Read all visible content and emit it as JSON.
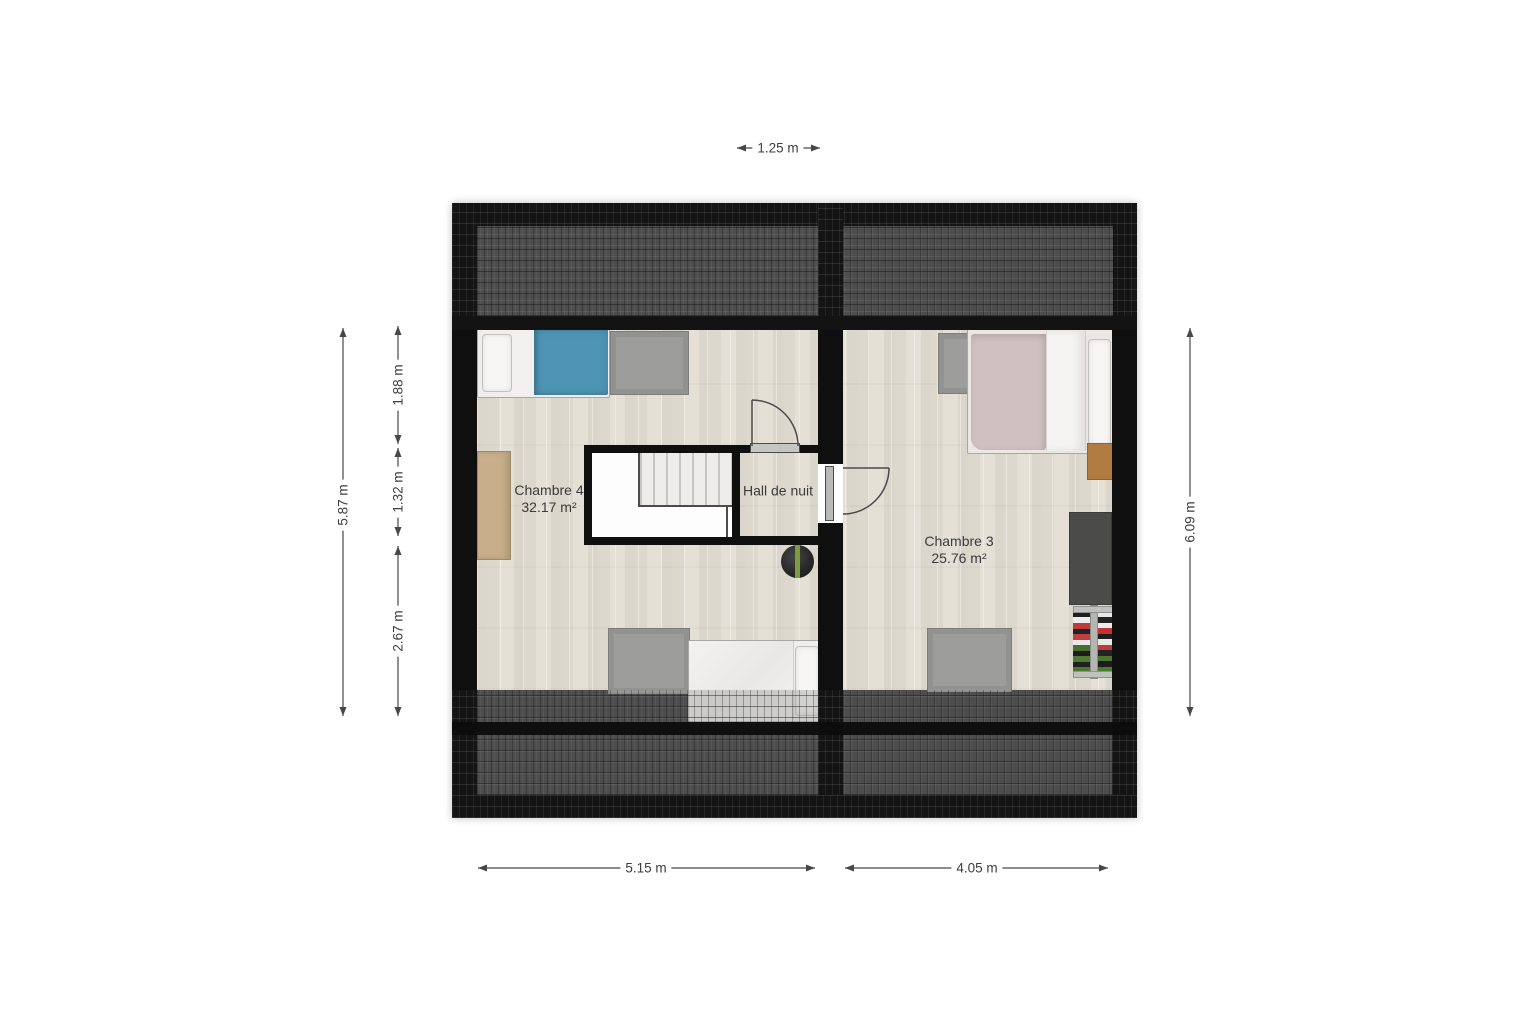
{
  "rooms": {
    "chambre4": {
      "name": "Chambre 4",
      "area": "32.17 m²"
    },
    "hall": {
      "name": "Hall de nuit"
    },
    "chambre3": {
      "name": "Chambre 3",
      "area": "25.76 m²"
    }
  },
  "dimensions": {
    "top_width": "1.25 m",
    "left_total": "5.87 m",
    "left_segment_1": "1.88 m",
    "left_segment_2": "1.32 m",
    "left_segment_3": "2.67 m",
    "right_total": "6.09 m",
    "bottom_left": "5.15 m",
    "bottom_right": "4.05 m"
  },
  "colors": {
    "wall_black": "#0f0f0f",
    "roof_tile_dark": "#141414",
    "roof_overlay_grey": "#9e9e9e",
    "floor_wood": "#e4e0d7",
    "blanket_blue": "#4e95b4",
    "blanket_mauve": "#cfc1c1",
    "rug_grey": "#9d9d9b",
    "wardrobe_tan": "#c8ae8a",
    "nightstand_brown": "#b07c42",
    "desk_dark_grey": "#4b4b49",
    "plant_green": "#7d9c40",
    "dimension_text": "#3d3d3d"
  }
}
